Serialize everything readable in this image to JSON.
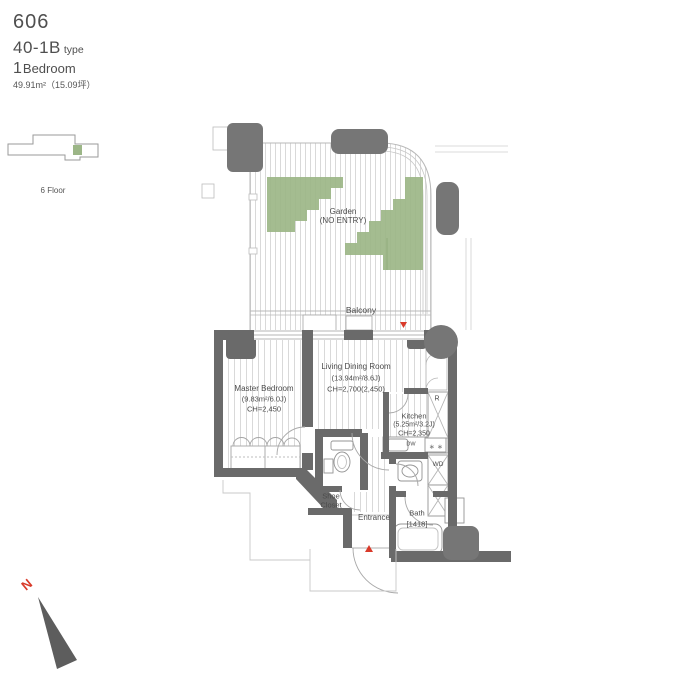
{
  "header": {
    "unit_number": "606",
    "plan_type": "40-1B",
    "plan_type_suffix": "type",
    "bedroom_count": "1",
    "bedroom_label": "Bedroom",
    "area_text": "49.91m²（15.09坪）"
  },
  "locator": {
    "floor_label": "6 Floor"
  },
  "plan": {
    "garden": {
      "label_line1": "Garden",
      "label_line2": "(NO ENTRY)"
    },
    "balcony": {
      "label": "Balcony"
    },
    "master_bedroom": {
      "label": "Master Bedroom",
      "size": "(9.83m²/6.0J)",
      "ceiling": "CH=2,450"
    },
    "living_dining": {
      "label": "Living Dining Room",
      "size": "(13.94m²/8.6J)",
      "ceiling": "CH=2,700(2,450)"
    },
    "kitchen": {
      "label": "Kitchen",
      "size": "(5.25m²/3.2J)",
      "ceiling": "CH=2,350",
      "dishwasher": "DW",
      "burners": "∗ ∗"
    },
    "refrigerator_label": "R",
    "washer_label": "WD",
    "shoe_closet": {
      "line1": "Shoe",
      "line2": "Closet"
    },
    "entrance": {
      "label": "Entrance"
    },
    "bath": {
      "label": "Bath",
      "size": "[1418]"
    }
  },
  "compass": {
    "north": "N"
  },
  "colors": {
    "garden_green": "#9cb687",
    "wall_gray": "#6a6a6a",
    "column_gray": "#767676",
    "accent_red": "#d93a2a"
  }
}
